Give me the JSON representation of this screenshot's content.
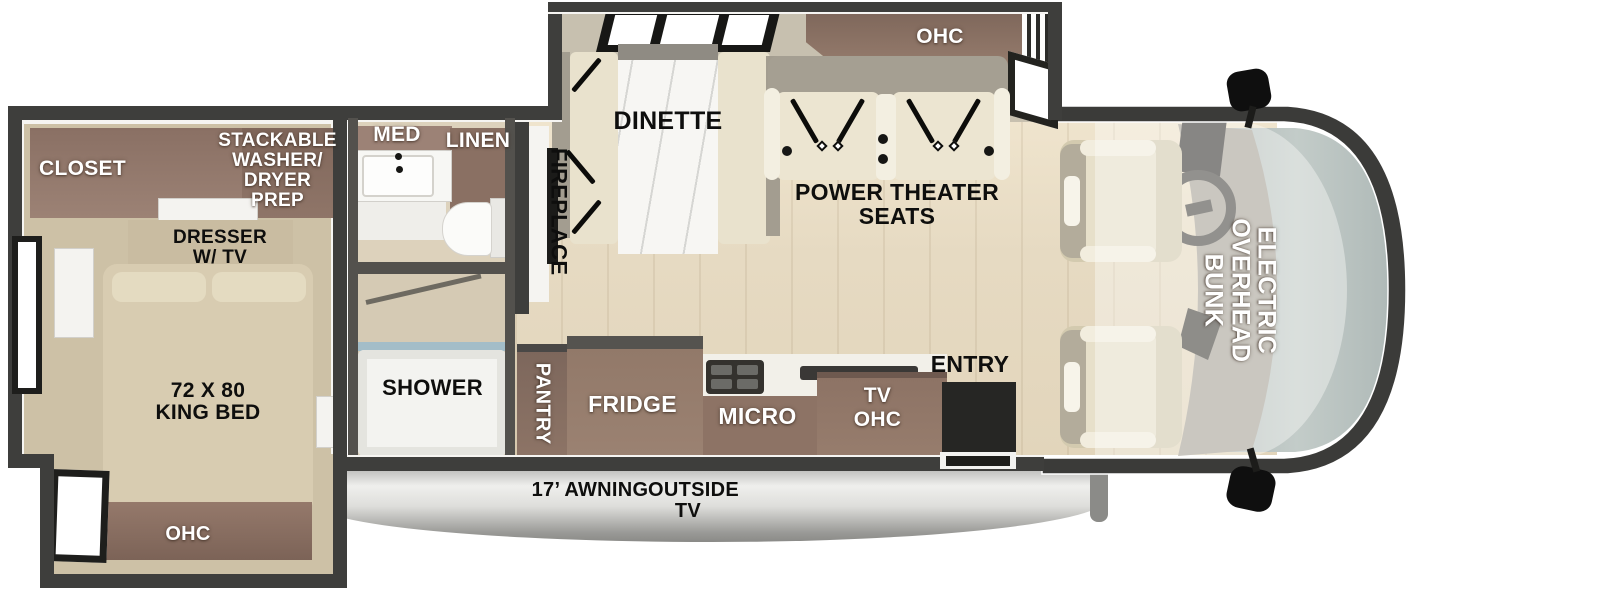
{
  "floorplan_title": "Class C motorhome floor plan",
  "bedroom": {
    "closet": "CLOSET",
    "washer_dryer": [
      "STACKABLE",
      "WASHER/",
      "DRYER",
      "PREP"
    ],
    "dresser": [
      "DRESSER",
      "W/ TV"
    ],
    "bed": [
      "72 X 80",
      "KING BED"
    ],
    "ohc": "OHC"
  },
  "bathroom": {
    "med": "MED",
    "linen": "LINEN",
    "shower": "SHOWER"
  },
  "living": {
    "fireplace": "FIREPLACE",
    "dinette": "DINETTE",
    "ohc": "OHC",
    "theater_seats": [
      "POWER THEATER",
      "SEATS"
    ]
  },
  "kitchen": {
    "pantry": "PANTRY",
    "fridge": "FRIDGE",
    "micro": "MICRO",
    "tv_ohc": [
      "TV",
      "OHC"
    ],
    "entry": "ENTRY"
  },
  "cab": {
    "bunk": [
      "ELECTRIC",
      "OVERHEAD",
      "BUNK"
    ]
  },
  "exterior": {
    "awning": "17’ AWNING",
    "outside_tv": [
      "OUTSIDE",
      "TV"
    ]
  },
  "colors": {
    "wall": "#3e3e3c",
    "bath_wall": "#53514d",
    "main_floor": "#e8dcc4",
    "bedroom_floor": "#cdc1a6",
    "cabinet_brown": "#8d7365",
    "closet_brown": "#8f7569",
    "seat_cream": "#ece5d1",
    "bed_tan": "#d8ccb1",
    "windshield": "#b7c1bf",
    "awning_silver": "#d9d9d9",
    "label_white": "#ffffff",
    "label_black": "#0e0e0d"
  }
}
